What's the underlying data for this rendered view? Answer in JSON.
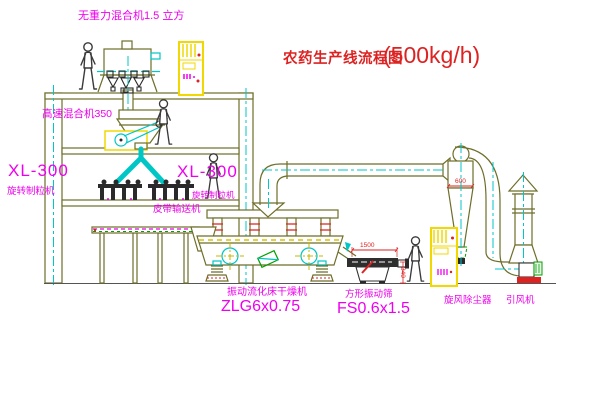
{
  "title": {
    "text": "农药生产线流程图",
    "capacity": "(500kg/h)"
  },
  "equipment_labels": {
    "gravity_mixer": "无重力混合机1.5 立方",
    "high_speed_mixer": "高速混合机350",
    "granulator_left": {
      "model": "XL-300",
      "name": "旋转制粒机"
    },
    "granulator_right": {
      "model": "XL-300",
      "name": "旋转制粒机"
    },
    "belt_conveyor": "皮带输送机",
    "fluid_bed_dryer": {
      "name": "振动流化床干燥机",
      "model": "ZLG6x0.75"
    },
    "vibrating_sieve": {
      "name": "方形振动筛",
      "model": "FS0.6x1.5"
    },
    "cyclone": "旋风除尘器",
    "induced_draft_fan": "引风机"
  },
  "dimensions": {
    "sieve_length": "1500",
    "sieve_outlet_height": "340",
    "cyclone_diameter": "600"
  },
  "colors": {
    "olive": "#6e6e2a",
    "cyan": "#00c6c6",
    "magenta": "#ee00ee",
    "red": "#dd2222",
    "yellow": "#f0d800",
    "green": "#00a000"
  }
}
